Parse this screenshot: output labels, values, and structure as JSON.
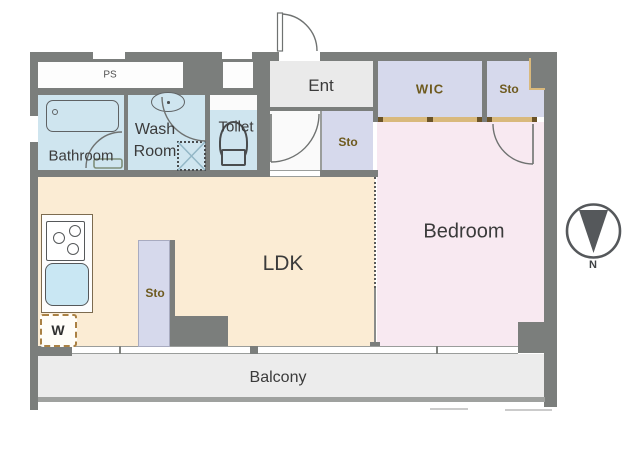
{
  "title": "1LDK apartment floor plan",
  "colors": {
    "wall": "#7b7e7c",
    "ldk_fill": "#fbecd4",
    "bedroom_fill": "#f8e9f1",
    "wet_fill": "#cfe5ef",
    "closet_fill": "#d6d9ec",
    "ent_fill": "#eaeaea",
    "hall_fill": "#fafafa",
    "balcony_fill": "#ececec",
    "track_tan": "#d9b97c",
    "track_dark": "#6b5327",
    "label_dark": "#3b3b3b",
    "label_brown": "#6e5a1e",
    "counter_border": "#7c6b4f",
    "sink_fill": "#c9e7f3",
    "arc_stroke": "#6f7271",
    "north_fill": "#55585b"
  },
  "rooms": {
    "ps": {
      "label": "PS"
    },
    "bathroom": {
      "label": "Bathroom"
    },
    "washroom": {
      "label_line1": "Wash",
      "label_line2": "Room"
    },
    "toilet": {
      "label": "Toilet"
    },
    "ent": {
      "label": "Ent"
    },
    "wic": {
      "label": "WIC"
    },
    "sto_upper_right": {
      "label": "Sto"
    },
    "sto_hall": {
      "label": "Sto"
    },
    "sto_ldk": {
      "label": "Sto"
    },
    "ldk": {
      "label": "LDK"
    },
    "bedroom": {
      "label": "Bedroom"
    },
    "balcony": {
      "label": "Balcony"
    }
  },
  "markers": {
    "washer": {
      "label": "W"
    },
    "north": {
      "label": "N"
    }
  }
}
